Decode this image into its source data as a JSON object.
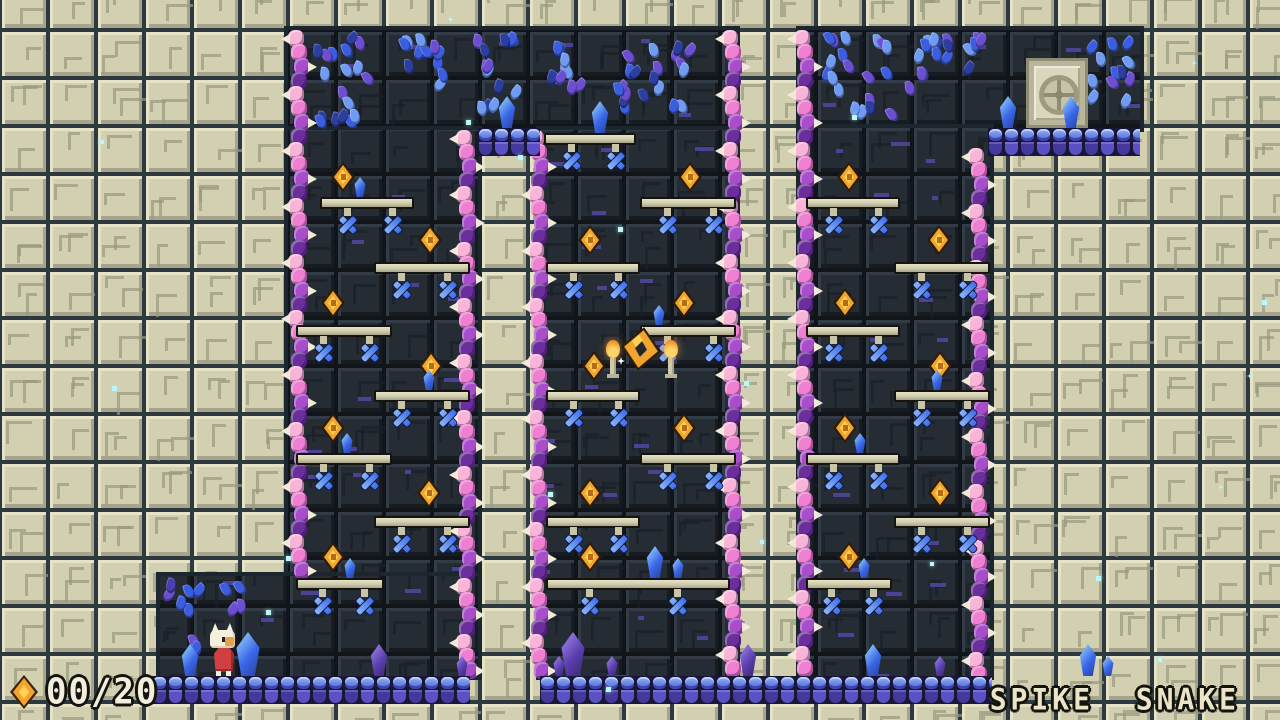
{
  "hud": {
    "coin_count": "00/20",
    "coin_icon": "gold-gem-icon"
  },
  "footer": {
    "title": "SPIKE  SNAKE"
  },
  "palette": {
    "stone_face": "#d3cfb1",
    "stone_light": "#e5e2c6",
    "stone_shadow": "#a7a48a",
    "stone_etch": "#97997f",
    "grout": "#2b3a41",
    "cave_face": "#252c34",
    "cave_light": "#323c46",
    "cave_shadow": "#171c22",
    "cave_etch": "#1a2028",
    "cave_grout": "#11151a",
    "cave_accent": "#5246a5",
    "vine_colors": [
      "#f9b5d8",
      "#ef7fd0",
      "#a94ecb",
      "#6a2f9c"
    ],
    "thorn": "#f2ead9",
    "spike_blue": "#3f6eea",
    "spike_light": "#8ab6f7",
    "gem_body": "#f2a52e",
    "gem_light": "#ffd257",
    "gem_dark": "#b96a14",
    "crystal_blue": "#3a67e8",
    "crystal_blue_light": "#7ab2f5",
    "crystal_purple": "#5a3fae",
    "crystal_purple_light": "#8a6fd8",
    "leaf_blue": "#3b5de0",
    "leaf_light": "#6f9cf2",
    "leaf_purple": "#6c4fd0",
    "leaf_dark": "#2c3e9e",
    "brick_light": "#8fb0f8",
    "brick_mid": "#5064d6",
    "brick_dark": "#45389c",
    "brick_alt": "#5b50c4",
    "door_frame": "#b9b59a",
    "door_panel": "#dad7bd",
    "door_emblem": "#c6c3a6",
    "door_line": "#8f8c74",
    "flame": "#f7a43a",
    "flame_core": "#ffd468",
    "player_red": "#d04040",
    "player_cream": "#f5efdd",
    "sparkle": "#bff6f4",
    "text": "#f2eedd",
    "outline": "#14140f"
  },
  "level": {
    "rooms": [
      [
        288,
        30,
        448,
        100
      ],
      [
        800,
        30,
        340,
        98
      ],
      [
        288,
        130,
        190,
        446
      ],
      [
        540,
        130,
        196,
        546
      ],
      [
        800,
        128,
        190,
        548
      ],
      [
        160,
        576,
        318,
        100
      ]
    ],
    "vines": [
      [
        288,
        30,
        546
      ],
      [
        456,
        130,
        546
      ],
      [
        528,
        130,
        546
      ],
      [
        722,
        30,
        646
      ],
      [
        794,
        30,
        646
      ],
      [
        968,
        148,
        528
      ]
    ],
    "caps": [
      [
        478,
        128,
        62
      ],
      [
        988,
        128,
        152
      ]
    ],
    "floors": [
      [
        152,
        676,
        318
      ],
      [
        540,
        676,
        452
      ]
    ],
    "platforms": [
      [
        320,
        197,
        94
      ],
      [
        374,
        262,
        96
      ],
      [
        296,
        325,
        96
      ],
      [
        374,
        390,
        96
      ],
      [
        296,
        453,
        96
      ],
      [
        374,
        516,
        96
      ],
      [
        296,
        578,
        88
      ],
      [
        544,
        133,
        92
      ],
      [
        640,
        197,
        96
      ],
      [
        546,
        262,
        94
      ],
      [
        640,
        325,
        96
      ],
      [
        546,
        390,
        94
      ],
      [
        640,
        453,
        96
      ],
      [
        546,
        516,
        94
      ],
      [
        546,
        578,
        184
      ],
      [
        806,
        197,
        94
      ],
      [
        894,
        262,
        96
      ],
      [
        806,
        325,
        94
      ],
      [
        894,
        390,
        96
      ],
      [
        806,
        453,
        94
      ],
      [
        894,
        516,
        96
      ],
      [
        806,
        578,
        86
      ]
    ],
    "gems": [
      [
        343,
        177
      ],
      [
        430,
        240
      ],
      [
        333,
        303
      ],
      [
        431,
        366
      ],
      [
        333,
        428
      ],
      [
        429,
        493
      ],
      [
        333,
        557
      ],
      [
        690,
        177
      ],
      [
        590,
        240
      ],
      [
        684,
        303
      ],
      [
        594,
        366
      ],
      [
        684,
        428
      ],
      [
        590,
        493
      ],
      [
        590,
        557
      ],
      [
        849,
        177
      ],
      [
        939,
        240
      ],
      [
        845,
        303
      ],
      [
        940,
        366
      ],
      [
        845,
        428
      ],
      [
        940,
        493
      ],
      [
        849,
        557
      ]
    ],
    "amulet": [
      641,
      349
    ],
    "torches": [
      [
        606,
        344
      ],
      [
        664,
        344
      ]
    ],
    "crystals": [
      [
        507,
        128,
        "m",
        "blue"
      ],
      [
        600,
        133,
        "m",
        "blue"
      ],
      [
        1008,
        128,
        "m",
        "blue"
      ],
      [
        1071,
        128,
        "m",
        "blue"
      ],
      [
        360,
        197,
        "s",
        "blue"
      ],
      [
        429,
        390,
        "s",
        "blue"
      ],
      [
        347,
        453,
        "s",
        "blue"
      ],
      [
        350,
        578,
        "s",
        "blue"
      ],
      [
        659,
        325,
        "s",
        "blue"
      ],
      [
        655,
        578,
        "m",
        "blue"
      ],
      [
        678,
        578,
        "s",
        "blue"
      ],
      [
        937,
        390,
        "s",
        "blue"
      ],
      [
        860,
        453,
        "s",
        "blue"
      ],
      [
        864,
        578,
        "s",
        "blue"
      ],
      [
        190,
        676,
        "m",
        "blue"
      ],
      [
        248,
        676,
        "l",
        "blue"
      ],
      [
        379,
        676,
        "m",
        "purple"
      ],
      [
        462,
        676,
        "s",
        "purple"
      ],
      [
        573,
        676,
        "l",
        "purple"
      ],
      [
        559,
        676,
        "s",
        "purple"
      ],
      [
        612,
        676,
        "s",
        "purple"
      ],
      [
        748,
        676,
        "m",
        "purple"
      ],
      [
        873,
        676,
        "m",
        "blue"
      ],
      [
        940,
        676,
        "s",
        "purple"
      ],
      [
        1088,
        676,
        "m",
        "blue"
      ],
      [
        1108,
        676,
        "s",
        "blue"
      ]
    ],
    "leaves": [
      [
        310,
        30,
        68,
        100,
        "b"
      ],
      [
        392,
        30,
        62,
        72,
        "b"
      ],
      [
        464,
        30,
        58,
        92,
        "b"
      ],
      [
        543,
        30,
        56,
        66,
        "b"
      ],
      [
        612,
        34,
        84,
        92,
        "b"
      ],
      [
        820,
        30,
        78,
        92,
        "b"
      ],
      [
        900,
        30,
        78,
        66,
        "b"
      ],
      [
        962,
        30,
        26,
        46,
        "b"
      ],
      [
        1086,
        30,
        52,
        88,
        "b"
      ],
      [
        162,
        578,
        44,
        82,
        "p"
      ],
      [
        220,
        578,
        34,
        48,
        "p"
      ]
    ],
    "door": {
      "x": 1026,
      "y": 58,
      "w": 62,
      "h": 70
    },
    "player": {
      "x": 208,
      "y": 628
    },
    "sparkles": [
      [
        447,
        16,
        7
      ],
      [
        466,
        120,
        5
      ],
      [
        518,
        155,
        5
      ],
      [
        618,
        227,
        5
      ],
      [
        852,
        115,
        5
      ],
      [
        1191,
        60,
        6
      ],
      [
        744,
        381,
        5
      ],
      [
        1247,
        373,
        6
      ],
      [
        112,
        386,
        5
      ],
      [
        548,
        492,
        5
      ],
      [
        286,
        556,
        5
      ],
      [
        266,
        610,
        5
      ],
      [
        1218,
        484,
        6
      ],
      [
        930,
        562,
        4
      ],
      [
        1096,
        576,
        5
      ],
      [
        606,
        687,
        5
      ],
      [
        760,
        540,
        4
      ],
      [
        1158,
        658,
        4
      ],
      [
        100,
        140,
        4
      ],
      [
        1262,
        300,
        5
      ]
    ]
  }
}
